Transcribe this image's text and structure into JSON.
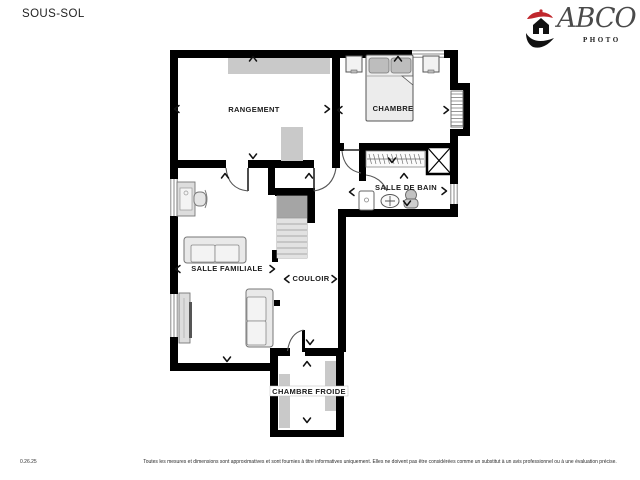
{
  "page": {
    "title": "SOUS-SOL"
  },
  "logo": {
    "brand": "ABCO",
    "subtitle": "PHOTO",
    "accent_color": "#c0272d",
    "mark_color": "#111111"
  },
  "plan": {
    "wall_color": "#000000",
    "furniture_fill": "#e9e9e9",
    "shelf_gray": "#c9c9c9",
    "rooms": [
      {
        "id": "rangement",
        "label": "RANGEMENT"
      },
      {
        "id": "chambre",
        "label": "CHAMBRE"
      },
      {
        "id": "salle-de-bain",
        "label": "SALLE DE BAIN"
      },
      {
        "id": "salle-familiale",
        "label": "SALLE FAMILIALE"
      },
      {
        "id": "couloir",
        "label": "COULOIR"
      },
      {
        "id": "chambre-froide",
        "label": "CHAMBRE FROIDE"
      }
    ]
  },
  "footer": {
    "date": "0.26.25",
    "disclaimer": "Toutes les mesures et dimensions sont approximatives et sont fournies à titre informatives uniquement. Elles ne doivent pas être considérées comme un substitut à un avis professionnel ou à une évaluation précise."
  }
}
